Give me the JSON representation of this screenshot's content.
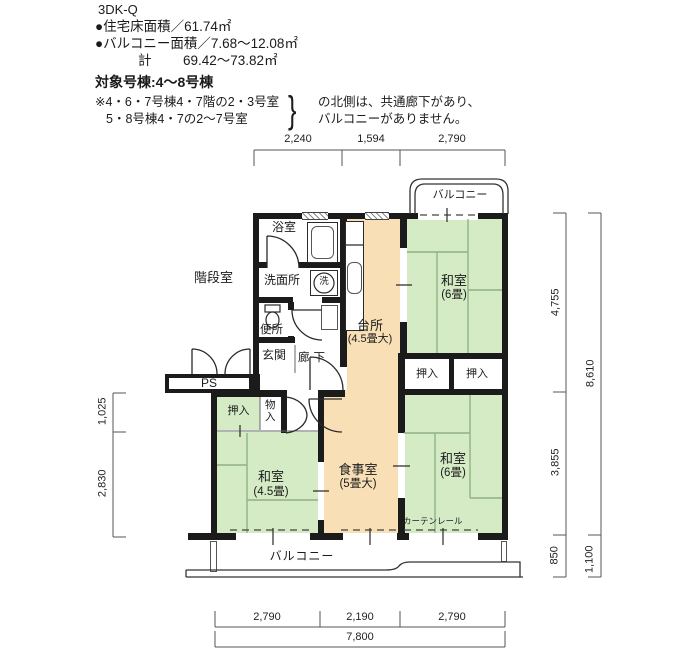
{
  "header": {
    "plan_code": "3DK-Q",
    "line_floor_area": "●住宅床面積／61.74㎡",
    "line_balcony_area": "●バルコニー面積／7.68～12.08㎡",
    "total_label": "計",
    "total_value": "69.42～73.82㎡",
    "target_line": "対象号棟:4～8号棟",
    "note1": "※4・6・7号棟4・7階の2・3号室",
    "note2": "5・8号棟4・7の2～7号室",
    "brace": "}",
    "note_r1": "の北側は、共通廊下があり、",
    "note_r2": "バルコニーがありません。"
  },
  "rooms": {
    "stairwell": "階段室",
    "bath": "浴室",
    "washroom": "洗面所",
    "washer": "洗",
    "toilet": "便所",
    "entrance": "玄関",
    "corridor": "廊下",
    "ps": "PS",
    "kitchen_l1": "台所",
    "kitchen_l2": "(4.5畳大)",
    "dining_l1": "食事室",
    "dining_l2": "(5畳大)",
    "washitsu_ne_l1": "和室",
    "washitsu_ne_l2": "(6畳)",
    "washitsu_se_l1": "和室",
    "washitsu_se_l2": "(6畳)",
    "washitsu_sw_l1": "和室",
    "washitsu_sw_l2": "(4.5畳)",
    "oshiire_ne1": "押入",
    "oshiire_ne2": "押入",
    "oshiire_sw": "押入",
    "monoiri": "物入",
    "balcony_top": "バルコニー",
    "balcony_bottom": "バルコニー",
    "curtain_rail": "カーテンレール"
  },
  "dims": {
    "top": [
      "2,240",
      "1,594",
      "2,790"
    ],
    "bottom": [
      "2,790",
      "2,190",
      "2,790"
    ],
    "bottom_total": "7,800",
    "right": [
      "4,755",
      "3,855",
      "850"
    ],
    "right_total": "8,610",
    "right_outer": "1,100",
    "left": [
      "1,025",
      "2,830"
    ]
  },
  "colors": {
    "tatami": "#d4ebc5",
    "kitchen": "#f8dfb6",
    "wall": "#1b1b1b"
  }
}
